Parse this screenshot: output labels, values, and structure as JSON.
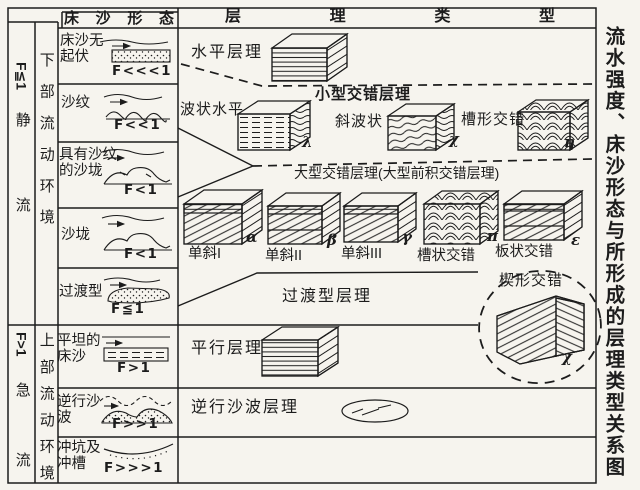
{
  "side_title": "流水强度、床沙形态与所形成的层理类型关系图",
  "header": {
    "bedform_col": "床沙形态",
    "bedding_col": "层理类型"
  },
  "regimes": {
    "upper": {
      "froude": "F≦1",
      "name": "静流",
      "env": "下部流动环境"
    },
    "lower": {
      "froude": "F>1",
      "name": "急流",
      "env": "上部流动环境"
    }
  },
  "bedforms": [
    {
      "label": "床沙无起伏",
      "froude": "F<<<1"
    },
    {
      "label": "沙纹",
      "froude": "F<<1"
    },
    {
      "label": "具有沙纹的沙垅",
      "froude": "F<1"
    },
    {
      "label": "沙垅",
      "froude": "F<1"
    },
    {
      "label": "过渡型",
      "froude": "F≦1"
    },
    {
      "label": "平坦的床沙",
      "froude": "F>1"
    },
    {
      "label": "逆行沙波",
      "froude": "F>>1"
    },
    {
      "label": "冲坑及冲槽",
      "froude": "F>>>1"
    }
  ],
  "bedding": {
    "horizontal": {
      "label": "水平层理"
    },
    "small_cross": {
      "title": "小型交错层理",
      "items": [
        {
          "label": "波状水平",
          "symbol": "λ"
        },
        {
          "label": "斜波状",
          "symbol": "χ"
        },
        {
          "label": "槽形交错",
          "symbol": "η"
        }
      ]
    },
    "large_cross": {
      "title": "大型交错层理(大型前积交错层理)",
      "items": [
        {
          "label": "单斜I",
          "symbol": "α"
        },
        {
          "label": "单斜II",
          "symbol": "β"
        },
        {
          "label": "单斜III",
          "symbol": "γ"
        },
        {
          "label": "槽状交错",
          "symbol": "π"
        },
        {
          "label": "板状交错",
          "symbol": "ε"
        }
      ]
    },
    "transitional": {
      "label": "过渡型层理"
    },
    "wedge": {
      "label": "楔形交错",
      "symbol": "χ"
    },
    "parallel": {
      "label": "平行层理"
    },
    "antidune": {
      "label": "逆行沙波层理"
    }
  },
  "colors": {
    "ink": "#1c1c1c",
    "paper": "#f6f4ee"
  }
}
